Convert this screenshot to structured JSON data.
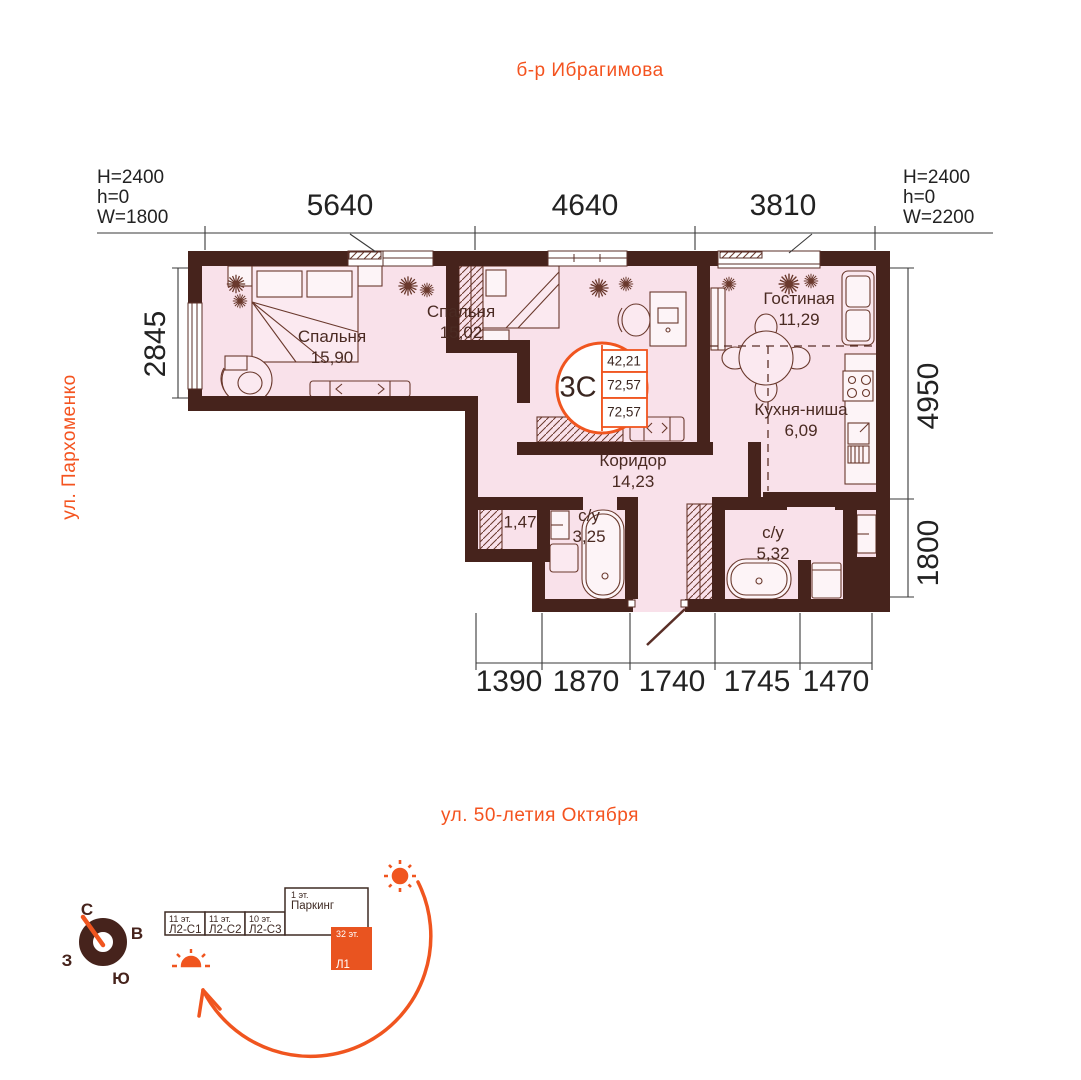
{
  "streets": {
    "top": "б-р Ибрагимова",
    "left": "ул. Пархоменко",
    "bottom": "ул. 50-летия Октября"
  },
  "specs": {
    "left": [
      "H=2400",
      "h=0",
      "W=1800"
    ],
    "right": [
      "H=2400",
      "h=0",
      "W=2200"
    ]
  },
  "dims": {
    "top": [
      "5640",
      "4640",
      "3810"
    ],
    "left": [
      "2845"
    ],
    "right": [
      "4950",
      "1800"
    ],
    "bottom": [
      "1390",
      "1870",
      "1740",
      "1745",
      "1470"
    ]
  },
  "badge": {
    "layout": "3С",
    "areas": [
      "42,21",
      "72,57",
      "72,57"
    ]
  },
  "rooms": [
    {
      "name": "Спальня",
      "area": "15,90"
    },
    {
      "name": "Спальня",
      "area": "15,02"
    },
    {
      "name": "Гостиная",
      "area": "11,29"
    },
    {
      "name": "Кухня-ниша",
      "area": "6,09"
    },
    {
      "name": "Коридор",
      "area": "14,23"
    },
    {
      "name": "",
      "area": "1,47"
    },
    {
      "name": "с/у",
      "area": "3,25"
    },
    {
      "name": "с/у",
      "area": "5,32"
    }
  ],
  "site": {
    "compass": {
      "n": "С",
      "e": "В",
      "s": "Ю",
      "w": "З"
    },
    "buildings": [
      {
        "floors": "11 эт.",
        "label": "Л2-С1"
      },
      {
        "floors": "11 эт.",
        "label": "Л2-С2"
      },
      {
        "floors": "10 эт.",
        "label": "Л2-С3"
      },
      {
        "floors": "1 эт.",
        "label": "Паркинг"
      },
      {
        "floors": "32 эт.",
        "label": "Л1"
      }
    ]
  },
  "colors": {
    "accent": "#f0551f",
    "wall": "#46231c",
    "floor": "#f9e1ea"
  }
}
